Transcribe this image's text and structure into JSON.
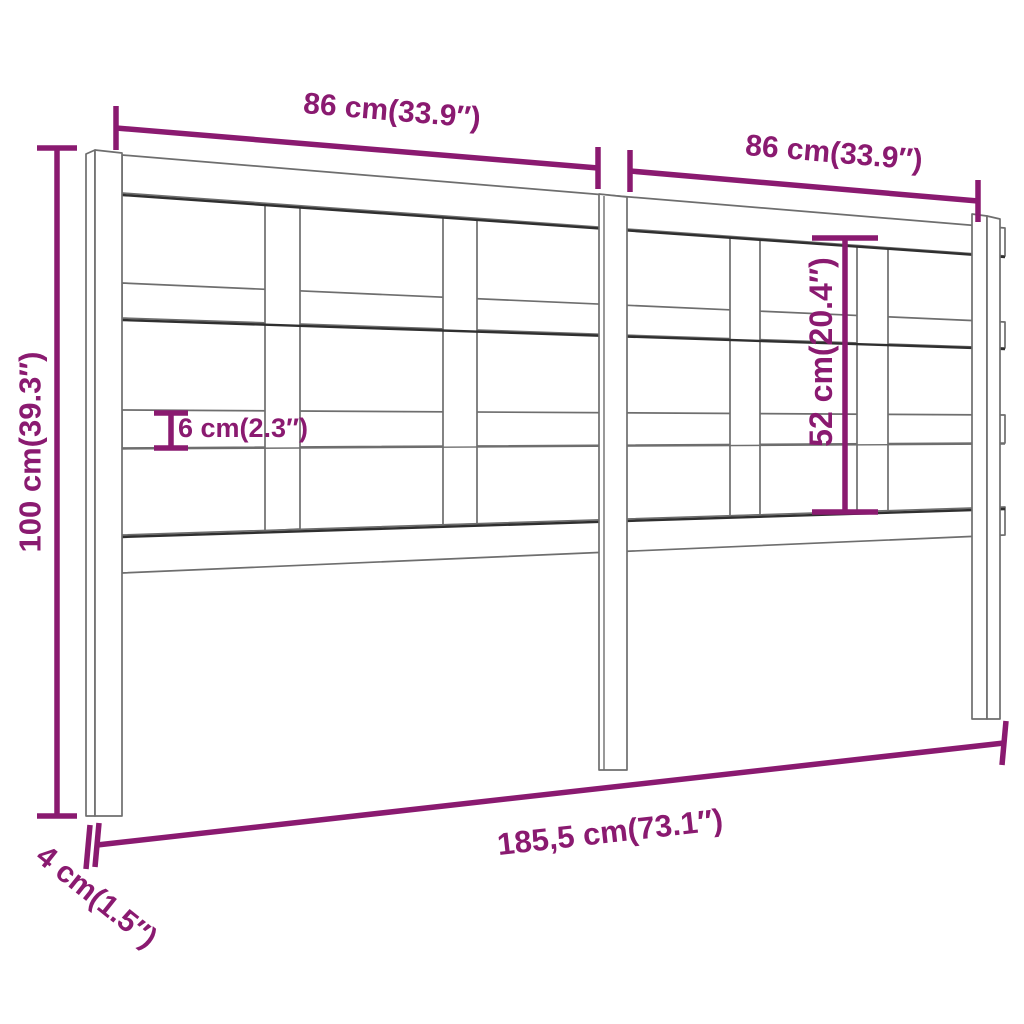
{
  "diagram": {
    "type": "product-dimension-diagram",
    "subject": "slatted wooden bed headboard, perspective line drawing",
    "colors": {
      "dimension": "#8a1a70",
      "outline": "#6e6e6e",
      "outline_dark": "#2f2f2f",
      "background": "#ffffff"
    },
    "dimensions": {
      "width_left": "86 cm(33.9″)",
      "width_right": "86 cm(33.9″)",
      "height": "100 cm(39.3″)",
      "rail_thickness": "6 cm(2.3″)",
      "inner_height": "52 cm(20.4″)",
      "total_width": "185,5 cm(73.1″)",
      "leg_depth": "4 cm(1.5″)"
    }
  }
}
